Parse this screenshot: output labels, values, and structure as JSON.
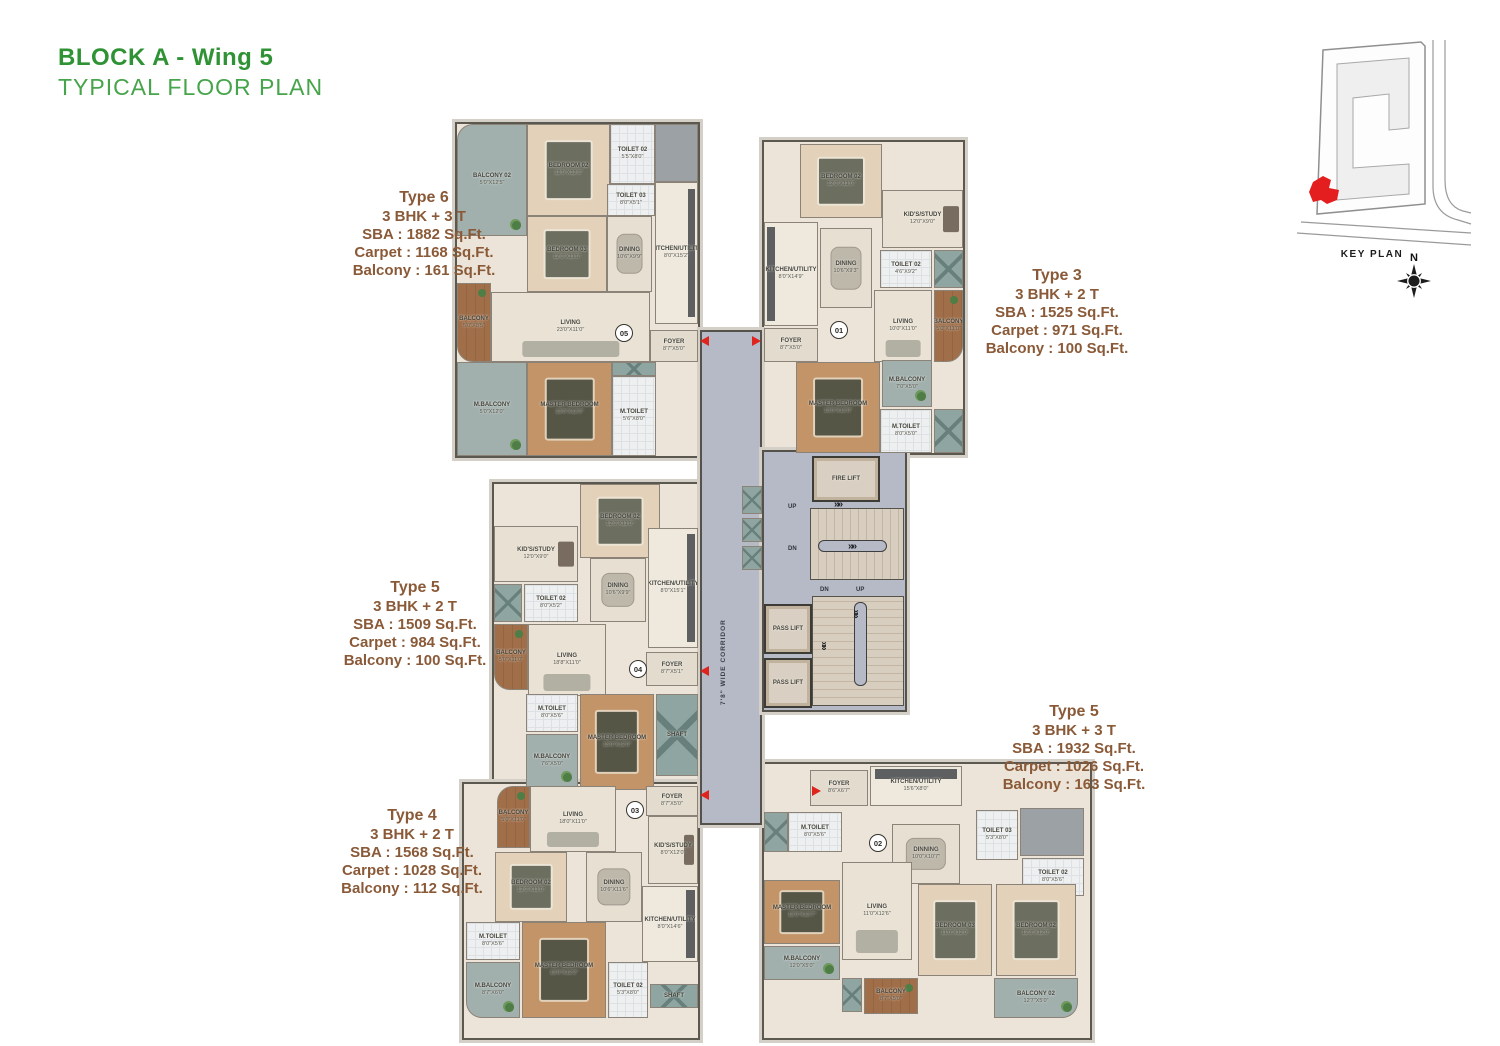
{
  "header": {
    "title_line1": "BLOCK A - Wing 5",
    "title_line2": "TYPICAL FLOOR PLAN"
  },
  "key_plan": {
    "label": "KEY PLAN",
    "compass_n": "N"
  },
  "colors": {
    "title_green": "#2f9235",
    "annotation_brown": "#8a5a38",
    "accent_red": "#de241d"
  },
  "icons": {
    "stair_arrow": "»»"
  },
  "annotations": [
    {
      "name": "Type 6",
      "config": "3 BHK + 3 T",
      "sba": "SBA : 1882 Sq.Ft.",
      "carpet": "Carpet : 1168 Sq.Ft.",
      "balcony": "Balcony : 161 Sq.Ft."
    },
    {
      "name": "Type 3",
      "config": "3 BHK + 2 T",
      "sba": "SBA : 1525 Sq.Ft.",
      "carpet": "Carpet : 971 Sq.Ft.",
      "balcony": "Balcony : 100 Sq.Ft."
    },
    {
      "name": "Type 5",
      "config": "3 BHK + 2 T",
      "sba": "SBA : 1509 Sq.Ft.",
      "carpet": "Carpet : 984 Sq.Ft.",
      "balcony": "Balcony : 100 Sq.Ft."
    },
    {
      "name": "Type 5",
      "config": "3 BHK + 3 T",
      "sba": "SBA : 1932 Sq.Ft.",
      "carpet": "Carpet : 1026 Sq.Ft.",
      "balcony": "Balcony : 163 Sq.Ft."
    },
    {
      "name": "Type 4",
      "config": "3 BHK + 2 T",
      "sba": "SBA : 1568 Sq.Ft.",
      "carpet": "Carpet : 1028 Sq.Ft.",
      "balcony": "Balcony : 112 Sq.Ft."
    }
  ],
  "core": {
    "corridor_label": "7'8\" WIDE CORRIDOR",
    "fire_lift": {
      "name": "FIRE LIFT"
    },
    "pass_lift": {
      "name": "PASS LIFT"
    },
    "shaft": {
      "name": "SHAFT"
    },
    "up": "UP",
    "dn": "DN"
  },
  "units": {
    "u05": {
      "number": "05",
      "rooms": {
        "balcony2": {
          "name": "BALCONY 02",
          "dims": "5'0\"X12'5\""
        },
        "bedroom2": {
          "name": "BEDROOM 02",
          "dims": "12'0\"X12'0\""
        },
        "toilet2": {
          "name": "TOILET 02",
          "dims": "5'5\"X8'0\""
        },
        "toilet3": {
          "name": "TOILET 03",
          "dims": "8'0\"X5'1\""
        },
        "bedroom3": {
          "name": "BEDROOM 03",
          "dims": "12'0\"X11'0\""
        },
        "dining": {
          "name": "DINING",
          "dims": "10'6\"X9'9\""
        },
        "kitchen": {
          "name": "KITCHEN/UTILITY",
          "dims": "8'0\"X15'2\""
        },
        "living": {
          "name": "LIVING",
          "dims": "23'0\"X11'0\""
        },
        "balcony": {
          "name": "BALCONY",
          "dims": "5'0\"X8'5\""
        },
        "master": {
          "name": "MASTER BEDROOM",
          "dims": "13'0\"X12'0\""
        },
        "mbalcony": {
          "name": "M.BALCONY",
          "dims": "5'0\"X12'0\""
        },
        "mtoilet": {
          "name": "M.TOILET",
          "dims": "5'6\"X8'0\""
        },
        "foyer": {
          "name": "FOYER",
          "dims": "8'7\"X5'0\""
        }
      }
    },
    "u01": {
      "number": "01",
      "rooms": {
        "bedroom2": {
          "name": "BEDROOM 02",
          "dims": "12'0\"X11'0\""
        },
        "kidsstudy": {
          "name": "KID'S/STUDY",
          "dims": "12'0\"X9'0\""
        },
        "toilet2": {
          "name": "TOILET 02",
          "dims": "4'6\"X9'2\""
        },
        "kitchen": {
          "name": "KITCHEN/UTILITY",
          "dims": "8'0\"X14'9\""
        },
        "dining": {
          "name": "DINING",
          "dims": "10'6\"X9'3\""
        },
        "living": {
          "name": "LIVING",
          "dims": "10'0\"X11'0\""
        },
        "balcony": {
          "name": "BALCONY",
          "dims": "5'0\"X11'0\""
        },
        "foyer": {
          "name": "FOYER",
          "dims": "8'7\"X5'0\""
        },
        "master": {
          "name": "MASTER BEDROOM",
          "dims": "13'0\"X12'0\""
        },
        "mbalcony": {
          "name": "M.BALCONY",
          "dims": "7'0\"X5'0\""
        },
        "mtoilet": {
          "name": "M.TOILET",
          "dims": "8'0\"X5'0\""
        }
      }
    },
    "u04": {
      "number": "04",
      "rooms": {
        "bedroom2": {
          "name": "BEDROOM 02",
          "dims": "12'0\"X11'0\""
        },
        "kidsstudy": {
          "name": "KID'S/STUDY",
          "dims": "12'0\"X9'0\""
        },
        "toilet2": {
          "name": "TOILET 02",
          "dims": "8'0\"X5'2\""
        },
        "balcony": {
          "name": "BALCONY",
          "dims": "5'0\"X11'0\""
        },
        "living": {
          "name": "LIVING",
          "dims": "18'8\"X11'0\""
        },
        "dining": {
          "name": "DINING",
          "dims": "10'6\"X9'9\""
        },
        "kitchen": {
          "name": "KITCHEN/UTILITY",
          "dims": "8'0\"X15'1\""
        },
        "foyer": {
          "name": "FOYER",
          "dims": "8'7\"X5'1\""
        },
        "mtoilet": {
          "name": "M.TOILET",
          "dims": "8'0\"X5'6\""
        },
        "master": {
          "name": "MASTER BEDROOM",
          "dims": "13'0\"X12'0\""
        },
        "mbalcony": {
          "name": "M.BALCONY",
          "dims": "7'6\"X5'0\""
        }
      }
    },
    "u03": {
      "number": "03",
      "rooms": {
        "balcony": {
          "name": "BALCONY",
          "dims": "5'0\"X11'0\""
        },
        "living": {
          "name": "LIVING",
          "dims": "18'0\"X11'0\""
        },
        "foyer": {
          "name": "FOYER",
          "dims": "8'7\"X5'0\""
        },
        "kidsstudy": {
          "name": "KID'S/STUDY",
          "dims": "8'0\"X12'0\""
        },
        "bedroom2": {
          "name": "BEDROOM 02",
          "dims": "12'0\"X11'0\""
        },
        "dining": {
          "name": "DINING",
          "dims": "10'6\"X11'6\""
        },
        "kitchen": {
          "name": "KITCHEN/UTILITY",
          "dims": "8'0\"X14'6\""
        },
        "mtoilet": {
          "name": "M.TOILET",
          "dims": "8'0\"X5'6\""
        },
        "master": {
          "name": "MASTER BEDROOM",
          "dims": "13'0\"X12'2\""
        },
        "mbalcony": {
          "name": "M.BALCONY",
          "dims": "8'7\"X6'0\""
        },
        "toilet2": {
          "name": "TOILET 02",
          "dims": "5'3\"X8'0\""
        }
      }
    },
    "u02": {
      "number": "02",
      "rooms": {
        "foyer": {
          "name": "FOYER",
          "dims": "8'6\"X6'7\""
        },
        "kitchen": {
          "name": "KITCHEN/UTILITY",
          "dims": "15'6\"X8'0\""
        },
        "mtoilet": {
          "name": "M.TOILET",
          "dims": "8'0\"X5'6\""
        },
        "dining": {
          "name": "DINNING",
          "dims": "10'0\"X10'7\""
        },
        "toilet3": {
          "name": "TOILET 03",
          "dims": "5'3\"X8'0\""
        },
        "toilet2": {
          "name": "TOILET 02",
          "dims": "8'0\"X5'6\""
        },
        "living": {
          "name": "LIVING",
          "dims": "11'0\"X12'6\""
        },
        "master": {
          "name": "MASTER BEDROOM",
          "dims": "12'0\"X13'7\""
        },
        "mbalcony": {
          "name": "M.BALCONY",
          "dims": "12'0\"X5'0\""
        },
        "balcony": {
          "name": "BALCONY",
          "dims": "8'7\"X5'0\""
        },
        "bedroom3": {
          "name": "BEDROOM 03",
          "dims": "11'0\"X12'0\""
        },
        "bedroom2": {
          "name": "BEDROOM 02",
          "dims": "12'3\"X12'0\""
        },
        "balcony2": {
          "name": "BALCONY 02",
          "dims": "12'7\"X5'0\""
        }
      }
    }
  }
}
